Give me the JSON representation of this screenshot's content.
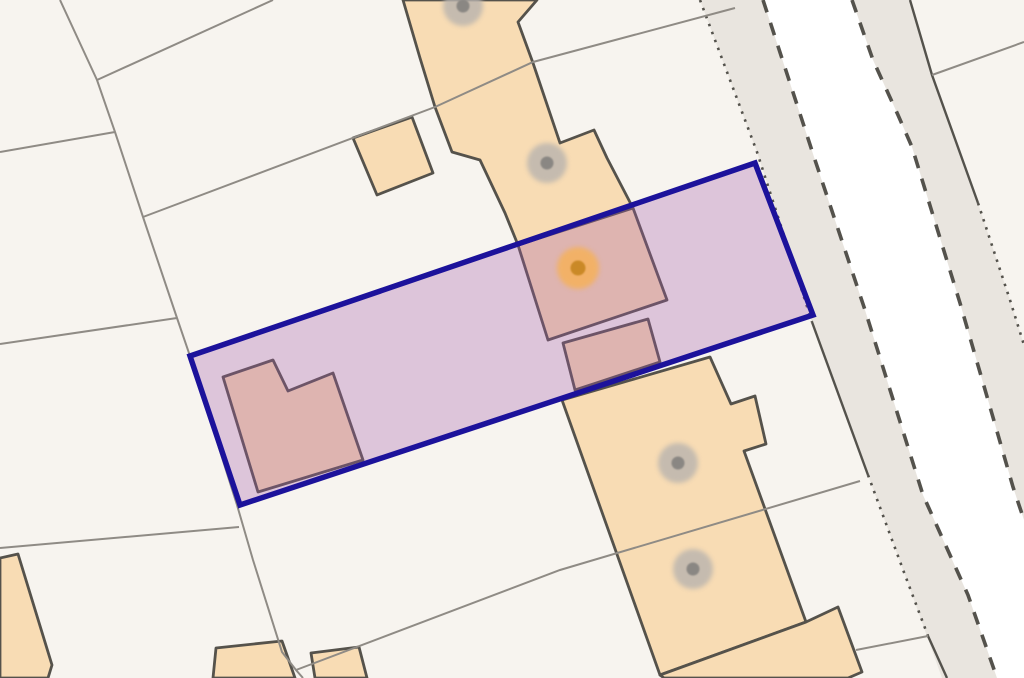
{
  "map": {
    "background": "#f7f4ef",
    "colors": {
      "parcel_line": "#8f8b85",
      "building_fill": "#f8dcb4",
      "building_stroke": "#55524b",
      "road_fill": "#e9e5df",
      "road_white": "#ffffff",
      "road_line": "#54524c",
      "plot_fill": "#a25aa8",
      "plot_fill_opacity": "0.30",
      "plot_stroke": "#1c129b",
      "marker_gray_outer": "#b8b3ae",
      "marker_gray_inner": "#8a8783",
      "marker_orange_outer": "#f2b163",
      "marker_orange_inner": "#ca8927"
    },
    "road": {
      "corridor": "700,0 757,152 812,322 868,475 905,575 942,678 1024,678 1024,345 1010,300 978,203 932,75 910,0",
      "carriageway": "763,0 815,160 865,310 923,495 968,595 997,678 1024,678 1024,520 1013,487 988,400 960,303 912,147 898,115 873,60 852,0",
      "edges": [
        {
          "name": "pavement-west-edge-upper",
          "style": "dotted",
          "points": "700,0 757,152 812,322"
        },
        {
          "name": "pavement-west-edge-mid",
          "style": "solid",
          "points": "812,322 868,475"
        },
        {
          "name": "pavement-west-edge-lower",
          "style": "dotted",
          "points": "868,475 905,575 928,636"
        },
        {
          "name": "pavement-west-edge-foot",
          "style": "solid",
          "points": "928,636 947,678"
        },
        {
          "name": "carriageway-west-edge",
          "style": "dashed",
          "points": "763,0 815,160 865,310 923,495 968,595 997,678"
        },
        {
          "name": "carriageway-east-edge",
          "style": "dashed",
          "points": "852,0 873,60 898,115 912,147 960,303 988,400 1013,487 1024,520"
        },
        {
          "name": "pavement-east-edge-upper",
          "style": "solid",
          "points": "910,0 932,75 978,203"
        },
        {
          "name": "pavement-east-edge-lower",
          "style": "dotted",
          "points": "978,203 1010,300 1024,345"
        }
      ]
    },
    "parcel_lines": [
      {
        "name": "boundary-west-long",
        "points": "60,0 97,80 115,132 143,217 177,318 190,356 237,505 253,560 282,652 296,670 303,678"
      },
      {
        "name": "boundary-northwest",
        "points": "97,80 273,0"
      },
      {
        "name": "boundary-west-branch-1",
        "points": "0,152 115,132"
      },
      {
        "name": "boundary-west-branch-2",
        "points": "0,344 177,318"
      },
      {
        "name": "boundary-north-diagonal",
        "points": "143,217 435,107 533,62 735,8"
      },
      {
        "name": "boundary-southwest",
        "points": "0,548 239,527"
      },
      {
        "name": "boundary-south-diagonal",
        "points": "296,670 560,570 860,481"
      },
      {
        "name": "boundary-northeast",
        "points": "932,75 1024,42"
      },
      {
        "name": "boundary-southeast",
        "points": "856,650 928,636"
      }
    ],
    "buildings": [
      {
        "name": "building-north-terrace",
        "points": "403,0 537,0 518,22 533,63 560,143 594,130 607,158 633,208 518,245 505,213 480,160 452,152 435,107 420,58"
      },
      {
        "name": "building-north-outbuilding",
        "points": "353,138 412,117 433,173 377,195"
      },
      {
        "name": "building-mid-house",
        "points": "518,245 633,208 667,300 548,340"
      },
      {
        "name": "building-mid-link",
        "points": "563,343 648,319 660,362 575,390"
      },
      {
        "name": "building-west-house",
        "points": "223,377 273,360 288,391 333,373 363,460 258,492"
      },
      {
        "name": "building-south-main",
        "points": "562,400 710,357 731,404 755,396 766,444 744,451 806,622 660,675"
      },
      {
        "name": "building-south-annex",
        "points": "660,675 806,622 838,607 862,672 848,678 664,678"
      },
      {
        "name": "building-west-edge",
        "points": "0,558 18,554 52,665 48,678 0,678"
      },
      {
        "name": "building-bottom-1",
        "points": "216,648 282,641 295,678 213,678"
      },
      {
        "name": "building-bottom-2",
        "points": "311,653 359,647 367,678 315,678"
      }
    ],
    "plot": {
      "name": "selected-plot-boundary",
      "points": "190,356 755,163 813,315 240,505"
    },
    "markers": [
      {
        "name": "building-marker-1",
        "x": 463,
        "y": 6,
        "kind": "gray"
      },
      {
        "name": "building-marker-2",
        "x": 547,
        "y": 163,
        "kind": "gray"
      },
      {
        "name": "building-marker-selected",
        "x": 578,
        "y": 268,
        "kind": "orange"
      },
      {
        "name": "building-marker-3",
        "x": 678,
        "y": 463,
        "kind": "gray"
      },
      {
        "name": "building-marker-4",
        "x": 693,
        "y": 569,
        "kind": "gray"
      }
    ],
    "marker_style": {
      "gray": {
        "outer_r": 20,
        "inner_r": 6.5,
        "outer_opacity": 0.8
      },
      "orange": {
        "outer_r": 21,
        "inner_r": 7.5,
        "outer_opacity": 0.95
      }
    }
  }
}
